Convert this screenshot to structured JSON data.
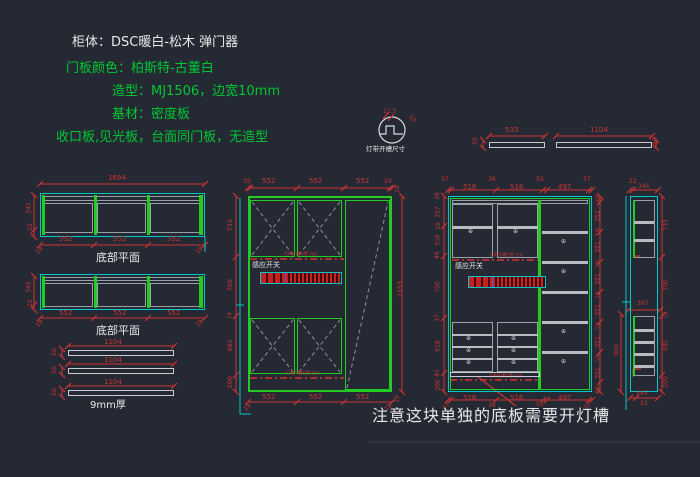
{
  "colors": {
    "background": "#242933",
    "green": "#00c832",
    "red": "#d03434",
    "cyan": "#00c8c8",
    "white": "#e8e8e8"
  },
  "header": {
    "line1": "柜体：DSC暖白-松木 弹门器",
    "line2": "门板颜色：柏斯特-古董白",
    "line3": "造型：MJ1506，边宽10mm",
    "line4": "基材：密度板",
    "line5": "收口板,见光板，台面同门板，无造型"
  },
  "detail": {
    "width_dim": "11.5",
    "side_dim": "10",
    "label": "灯带开槽尺寸"
  },
  "top_bars": {
    "dim1": "533",
    "dim2": "1104",
    "thickness": "50"
  },
  "plans": {
    "overall": "1694",
    "depth": "345",
    "back": "22",
    "sections": [
      "552",
      "552",
      "552"
    ],
    "edge": "19",
    "label1": "底部平面",
    "label2": "底部平面"
  },
  "boards": {
    "length": "1104",
    "width": "50",
    "label": "9mm厚"
  },
  "mid_cab": {
    "top": [
      "19",
      "552",
      "552",
      "552",
      "19"
    ],
    "left": [
      "733",
      "700",
      "19",
      "681",
      "200"
    ],
    "right": [
      "19",
      "2333",
      "19"
    ],
    "bottom": [
      "552",
      "552",
      "552"
    ],
    "corner": "19",
    "sensor": "感应开关",
    "note": "灯带开槽位置 白光"
  },
  "right_cab": {
    "top": [
      "37",
      "516",
      "36",
      "516",
      "55",
      "497",
      "37"
    ],
    "bottom": [
      "37",
      "516",
      "36",
      "516",
      "55",
      "497",
      "37"
    ],
    "left": [
      "38",
      "317",
      "18",
      "316",
      "46",
      "700",
      "37",
      "618",
      "45",
      "200"
    ],
    "right": [
      "68",
      "352",
      "18",
      "351",
      "18",
      "351",
      "18",
      "351",
      "18",
      "351",
      "18",
      "351",
      "68"
    ],
    "sensor": "感应开关",
    "note": "灯带开槽位置 白光"
  },
  "side_view": {
    "top_back": "22",
    "top_depth": "345",
    "mid": "367",
    "bottom_depth": "345",
    "bottom_back": "22",
    "right": [
      "733",
      "700",
      "19",
      "681",
      "200"
    ],
    "left": "900"
  },
  "warning": "注意这块单独的底板需要开灯槽",
  "symbols": {
    "hole": "⊕"
  }
}
